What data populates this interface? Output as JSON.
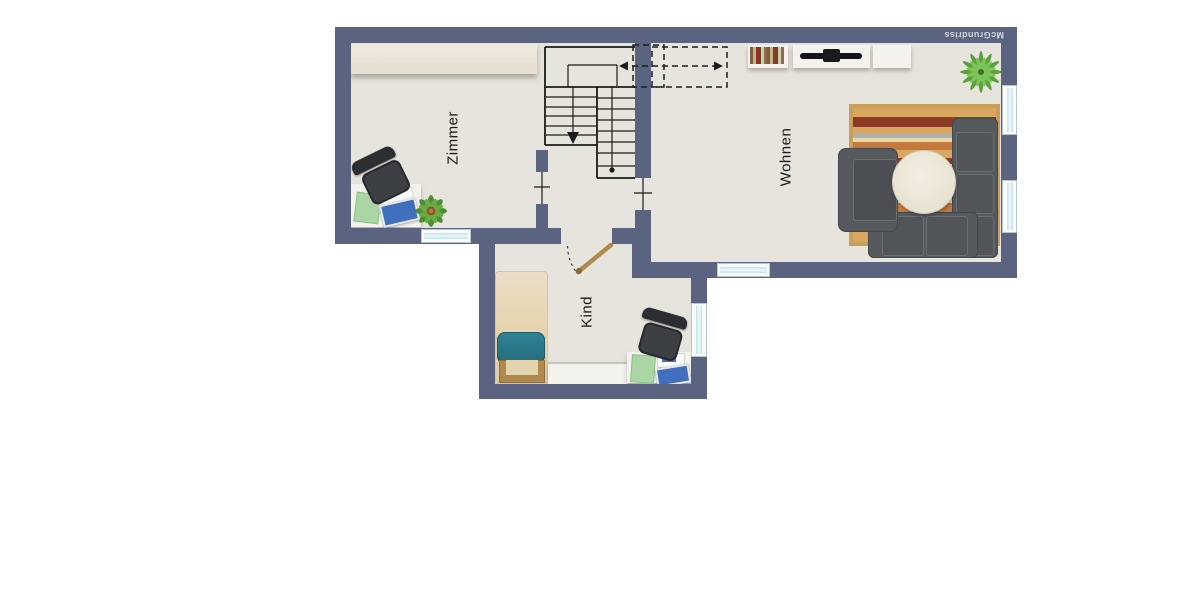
{
  "watermark": {
    "text": "McGrundriss"
  },
  "rooms": {
    "zimmer": {
      "label": "Zimmer"
    },
    "wohnen": {
      "label": "Wohnen"
    },
    "kind": {
      "label": "Kind"
    }
  },
  "colors": {
    "wall": "#5a6380",
    "floor": "#e7e4dd",
    "outline": "#1c1c1c",
    "window_frame": "#f8fafb",
    "window_glass": "#cfe9ef",
    "sofa_dark": "#565a5e",
    "sofa_seam": "#6b6f74",
    "rug_border": "#c9a05a",
    "table": "#eee9dc",
    "wood": "#b0894e",
    "teal_pillow": "#2b7d8e",
    "plant_green": "#5fa23c",
    "desk_white": "#f4f2ec",
    "paper_green": "#a9d6a4",
    "laptop_blue": "#3f6fbe",
    "chair_dark": "#35383b",
    "label_color": "#1b1b1b",
    "watermark_color": "#d4d6e0"
  }
}
